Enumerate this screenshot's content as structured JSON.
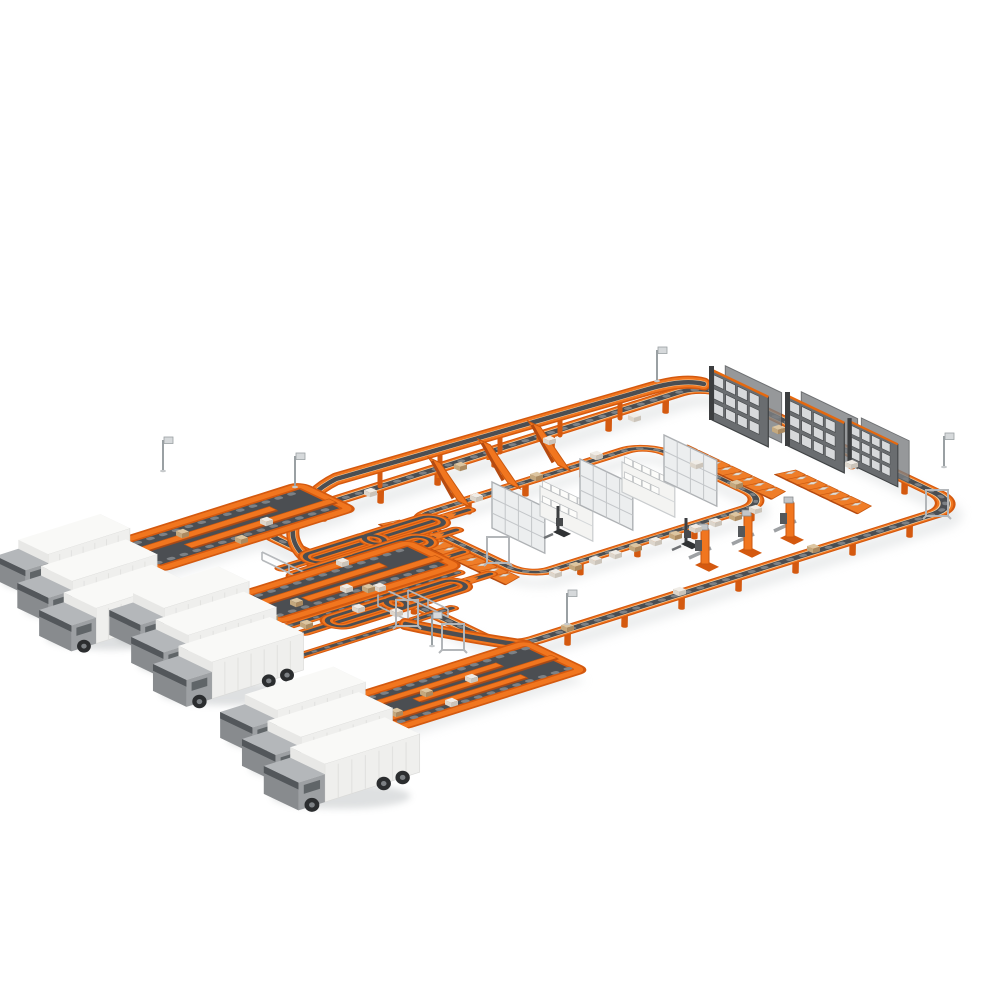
{
  "scene": {
    "title": "Isometric 3D illustration of an automated warehouse parcel sortation system with orange conveyor loops and delivery trucks",
    "background": "#ffffff",
    "colors": {
      "orange": "#f1761f",
      "orange_dark": "#c9570f",
      "orange_deep": "#d4590f",
      "rail_highlight": "#f7d3a6",
      "belt": "#4b4e52",
      "belt_roller": "#7d8185",
      "steel_light": "#b5b8bb",
      "steel_mid": "#9aa0a3",
      "frame_dark": "#4a4d50",
      "truck_white": "#f6f6f4",
      "truck_cab": "#9da0a3",
      "glass": "#53575b",
      "tire": "#2b2d2f",
      "package_white": "#efece6",
      "package_tan": "#d9c09a",
      "rack_grey": "#c3c6c9",
      "shadow": "#ccd0d2"
    },
    "counts": {
      "trucks": 9,
      "truck_groups": 3,
      "serpentine_docks": 3,
      "sorter_spur_lanes": 4,
      "cross_lanes": 2,
      "incline_ramps": 3,
      "chute_rows": 3,
      "chutes_total": 27,
      "storage_racks": 5,
      "asrs_rack_blocks": 3,
      "lift_stations": 3,
      "sign_posts": 6,
      "gate_frames": 4,
      "forklifts": 2,
      "parcels_on_belts": 41
    },
    "labels": {
      "main_loop": "Main sortation loop conveyor",
      "inner_loop": "Inner buffer loop conveyor",
      "feed_line": "Elevated feed conveyor line",
      "sorter": "Central sorter with spur lanes",
      "docks": "Serpentine truck-loading docks",
      "trucks": "Box delivery trucks",
      "racks": "Warehouse shelving racks",
      "asrs": "Tote storage rack blocks",
      "stations": "Lift transfer stations"
    }
  }
}
